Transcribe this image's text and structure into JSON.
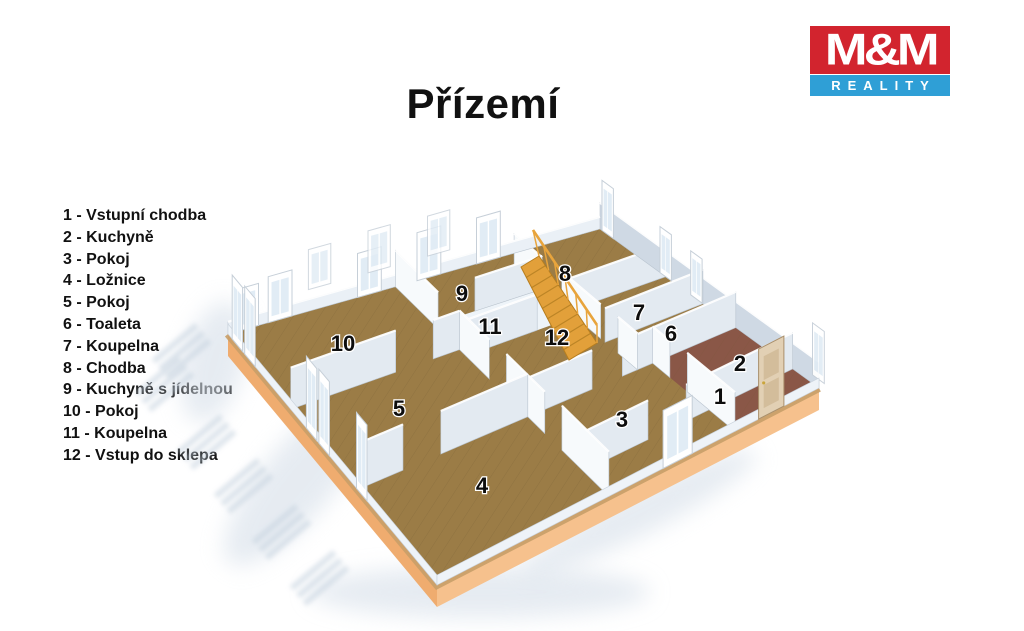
{
  "title": "Přízemí",
  "logo": {
    "mm": "M&M",
    "reality": "REALITY",
    "red": "#d2242e",
    "blue": "#2f9fd6"
  },
  "legend": {
    "separator": " - ",
    "items": [
      {
        "num": "1",
        "name": "Vstupní chodba"
      },
      {
        "num": "2",
        "name": "Kuchyně"
      },
      {
        "num": "3",
        "name": "Pokoj"
      },
      {
        "num": "4",
        "name": "Ložnice"
      },
      {
        "num": "5",
        "name": "Pokoj"
      },
      {
        "num": "6",
        "name": "Toaleta"
      },
      {
        "num": "7",
        "name": "Koupelna"
      },
      {
        "num": "8",
        "name": "Chodba"
      },
      {
        "num": "9",
        "name": "Kuchyně s jídelnou"
      },
      {
        "num": "10",
        "name": "Pokoj"
      },
      {
        "num": "11",
        "name": "Koupelna"
      },
      {
        "num": "12",
        "name": "Vstup do sklepa"
      }
    ]
  },
  "floorplan": {
    "room_labels": [
      {
        "num": "1",
        "x": 720,
        "y": 404
      },
      {
        "num": "2",
        "x": 740,
        "y": 371
      },
      {
        "num": "3",
        "x": 622,
        "y": 427
      },
      {
        "num": "4",
        "x": 482,
        "y": 493
      },
      {
        "num": "5",
        "x": 399,
        "y": 416
      },
      {
        "num": "6",
        "x": 671,
        "y": 341
      },
      {
        "num": "7",
        "x": 639,
        "y": 320
      },
      {
        "num": "8",
        "x": 565,
        "y": 281
      },
      {
        "num": "9",
        "x": 462,
        "y": 301
      },
      {
        "num": "10",
        "x": 343,
        "y": 351
      },
      {
        "num": "11",
        "x": 490,
        "y": 334
      },
      {
        "num": "12",
        "x": 557,
        "y": 345
      }
    ],
    "colors": {
      "floor": "#9b7c46",
      "floor_seam": "#6f5730",
      "kitchen_tile": "#8a5747",
      "bath_floor": "#eef4f9",
      "rim": "#c89f68",
      "plinth": "#efac6f",
      "plinth_light": "#f6c18d",
      "wall_white": "#f7fafc",
      "wall_shaded": "#e3eaf1",
      "wall_back": "#cfd9e4",
      "wall_back_low": "#eaf0f6",
      "stair": "#e2a03a",
      "stair_edge": "#b87e1e",
      "rail": "#e8a43c",
      "door": "#e2d0b4",
      "door_panel": "#d3bd9b",
      "shadow": "#c2cfdd",
      "shadow_soft": "#d6dfe9",
      "window_pane": "#dce9f3",
      "frame_stroke": "#c6cfd8"
    }
  }
}
